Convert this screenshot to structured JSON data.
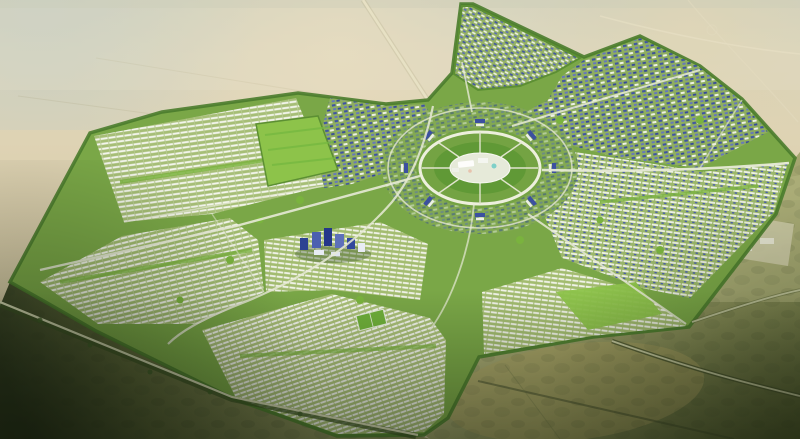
{
  "scene": {
    "title": "Aerial rendering of a master-planned desert city with a circular civic core",
    "description": "High oblique bird's-eye architectural visualization of a new-town masterplan: a white central plaza ringed by circular boulevards, radiating avenues, dense low-rise residential grids with white and blue roofs, landscaped parks and tree-lined edges, all surrounded by open desert with access roads leading away to the horizon.",
    "canvas": {
      "width": 800,
      "height": 439
    },
    "environment": {
      "setting": "open desert plain, hazy daylight",
      "view": "high oblique aerial render",
      "ground_top": "pale sand",
      "ground_bottom": "dark olive scrubland"
    },
    "palette": {
      "desert_pale": "#d8d3bb",
      "desert_sand": "#ddd2ae",
      "desert_olive_dark": "#3b4527",
      "desert_khaki": "#a8a262",
      "city_green": "#7aa747",
      "park_green": "#8dc34a",
      "tree_green": "#4a7c2c",
      "building_white": "#f3f5ec",
      "roof_blue_dark": "#3d51a1",
      "roof_blue_light": "#6b7ec6",
      "plaza_white": "#e6ead9",
      "road_white": "#edefdd",
      "road_desert": "#d8d3b2"
    },
    "landmarks": [
      {
        "id": "central-plaza",
        "label": "Central civic plaza with white landmark buildings"
      },
      {
        "id": "ring-road",
        "label": "Inner ring boulevard around the core"
      },
      {
        "id": "outer-ring-road",
        "label": "Outer circular arc road"
      },
      {
        "id": "grand-park",
        "label": "Large rectangular green park west of the core"
      },
      {
        "id": "cbd-towers",
        "label": "Cluster of mid/high-rise towers south-west of the core"
      },
      {
        "id": "sports-field",
        "label": "Small green sports field in the southern grid"
      },
      {
        "id": "construction-pad",
        "label": "Cleared light-colored site in the desert east of the city"
      }
    ],
    "districts": [
      {
        "id": "northwest-residential",
        "label": "Northwest residential grid",
        "character": "dense low-rise rows, white roofs"
      },
      {
        "id": "west-residential",
        "label": "West residential grid",
        "character": "white row housing with green strips"
      },
      {
        "id": "southwest-residential",
        "label": "Southwest residential grid",
        "character": "densest white row housing"
      },
      {
        "id": "south-central-mixed",
        "label": "South-central mixed district",
        "character": "contains high-rise cluster"
      },
      {
        "id": "southeast-residential",
        "label": "Southeast residential grid",
        "character": "white rows, parks"
      },
      {
        "id": "east-residential",
        "label": "East residential grid",
        "character": "white and blue roofs"
      },
      {
        "id": "northeast-mixed",
        "label": "Northeast mixed district",
        "character": "blue-roofed apartment blocks"
      },
      {
        "id": "north-central",
        "label": "North-central core district",
        "character": "blue-roofed blocks around the ring"
      },
      {
        "id": "north-gateway-triangle",
        "label": "Triangular northern gateway district",
        "character": "wedge between entrance roads"
      }
    ],
    "roads": [
      {
        "id": "gateway-road-north",
        "label": "Straight desert approach road from the north"
      },
      {
        "id": "east-boulevard",
        "label": "East radial boulevard"
      },
      {
        "id": "northeast-boulevard",
        "label": "Northeast radial boulevard"
      },
      {
        "id": "southeast-boulevard",
        "label": "Southeast radial boulevard"
      },
      {
        "id": "west-boulevard",
        "label": "West radial boulevard"
      },
      {
        "id": "southwest-edge-road",
        "label": "Tree-lined road along the southwest city edge"
      },
      {
        "id": "southeast-exit-road",
        "label": "Road exiting to the bottom-right desert"
      },
      {
        "id": "east-exit-road",
        "label": "Road exiting to the east"
      },
      {
        "id": "desert-tracks",
        "label": "Faint tracks and highway lines in the northern desert"
      }
    ]
  }
}
